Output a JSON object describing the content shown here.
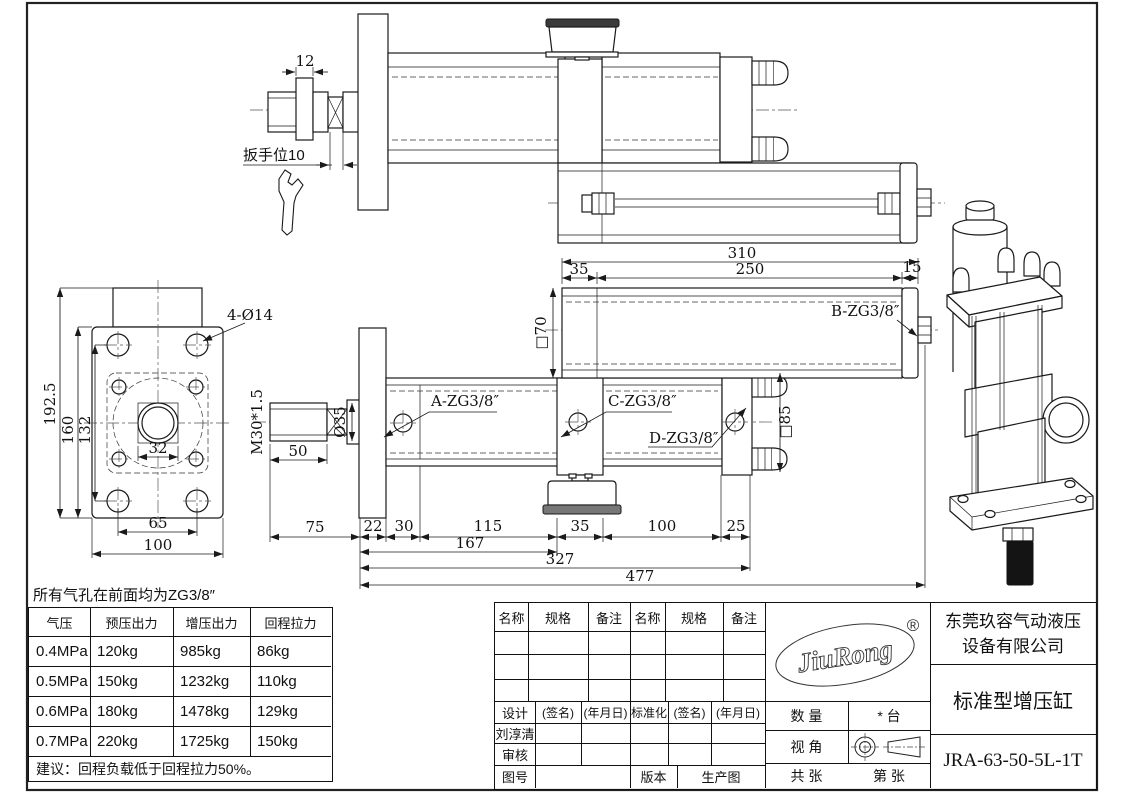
{
  "note": "所有气孔在前面均为ZG3/8″",
  "dims": {
    "d12": "12",
    "wrench": "扳手位10",
    "h1925": "192.5",
    "h160": "160",
    "h132": "132",
    "w32": "32",
    "w65": "65",
    "w100": "100",
    "holes": "4-Ø14",
    "thread": "M30*1.5",
    "dia35": "Ø35",
    "len50": "50",
    "r75": "75",
    "r22": "22",
    "r30": "30",
    "r115": "115",
    "r35": "35",
    "r100": "100",
    "r25": "25",
    "t167": "167",
    "t327": "327",
    "t477": "477",
    "b310": "310",
    "b35": "35",
    "b250": "250",
    "b15": "15",
    "sq70": "□70",
    "sq85": "□85",
    "portA": "A-ZG3/8″",
    "portB": "B-ZG3/8″",
    "portC": "C-ZG3/8″",
    "portD": "D-ZG3/8″"
  },
  "force_table": {
    "headers": [
      "气压",
      "预压出力",
      "增压出力",
      "回程拉力"
    ],
    "rows": [
      [
        "0.4MPa",
        "120kg",
        "985kg",
        "86kg"
      ],
      [
        "0.5MPa",
        "150kg",
        "1232kg",
        "110kg"
      ],
      [
        "0.6MPa",
        "180kg",
        "1478kg",
        "129kg"
      ],
      [
        "0.7MPa",
        "220kg",
        "1725kg",
        "150kg"
      ]
    ],
    "suggestion": "建议：回程负载低于回程拉力50%。"
  },
  "title_block": {
    "bom_name": "名称",
    "bom_spec": "规格",
    "bom_note": "备注",
    "design": "设计",
    "sign": "(签名)",
    "date": "(年月日)",
    "standardization": "标准化",
    "designer": "刘淳清",
    "review": "审核",
    "drawing_no": "图号",
    "version": "版本",
    "production": "生产图",
    "logo_text": "JiuRong",
    "registered": "®",
    "company_line1": "东莞玖容气动液压",
    "company_line2": "设备有限公司",
    "product": "标准型增压缸",
    "model": "JRA-63-50-5L-1T",
    "qty_label": "数 量",
    "qty_value": "* 台",
    "view_label": "视 角",
    "sheets_total": "共 张",
    "sheet_no": "第 张"
  }
}
